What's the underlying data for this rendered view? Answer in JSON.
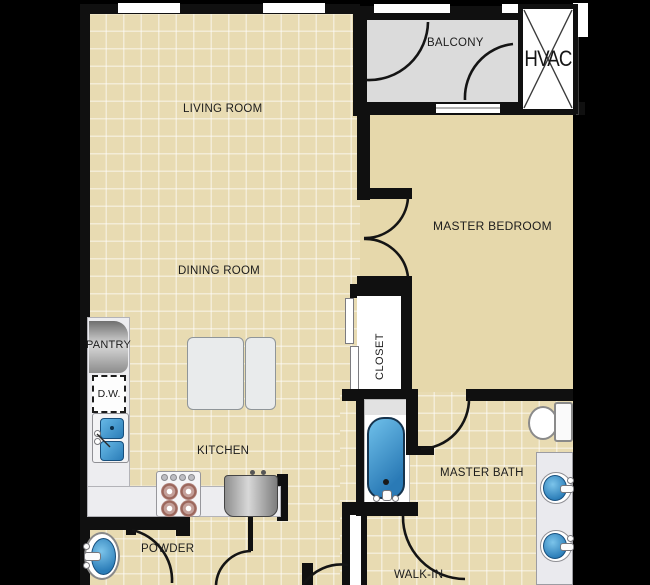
{
  "rooms": {
    "living": {
      "label": "LIVING ROOM"
    },
    "dining": {
      "label": "DINING ROOM"
    },
    "kitchen": {
      "label": "KITCHEN"
    },
    "pantry": {
      "label": "PANTRY"
    },
    "dishwasher": {
      "label": "D.W."
    },
    "powder": {
      "label": "POWDER"
    },
    "closet": {
      "label": "CLOSET"
    },
    "master_bedroom": {
      "label": "MASTER BEDROOM"
    },
    "master_bath": {
      "label": "MASTER BATH"
    },
    "balcony": {
      "label": "BALCONY"
    },
    "hvac": {
      "label": "HVAC"
    },
    "walk_in": {
      "label": "WALK-IN"
    }
  },
  "fixtures": [
    "dining-table",
    "kitchen-sink",
    "dishwasher",
    "range-stove",
    "refrigerator",
    "pantry-counter",
    "bathtub",
    "toilet",
    "double-vanity-sinks",
    "pedestal-sink",
    "hvac-unit",
    "door-swings",
    "windows",
    "closet-sliding-doors"
  ],
  "colors": {
    "background": "#000000",
    "wall": "#101010",
    "tile_floor": "#e8dbb2",
    "tile_grout": "#f6efd8",
    "bedroom_floor": "#e6d8ab",
    "balcony_floor": "#dbdbdb",
    "counter": "#ededf0",
    "fixture_blue": "#2b7db8",
    "appliance_gray": "#b8b8b8",
    "label_text": "#1c1c1c"
  }
}
